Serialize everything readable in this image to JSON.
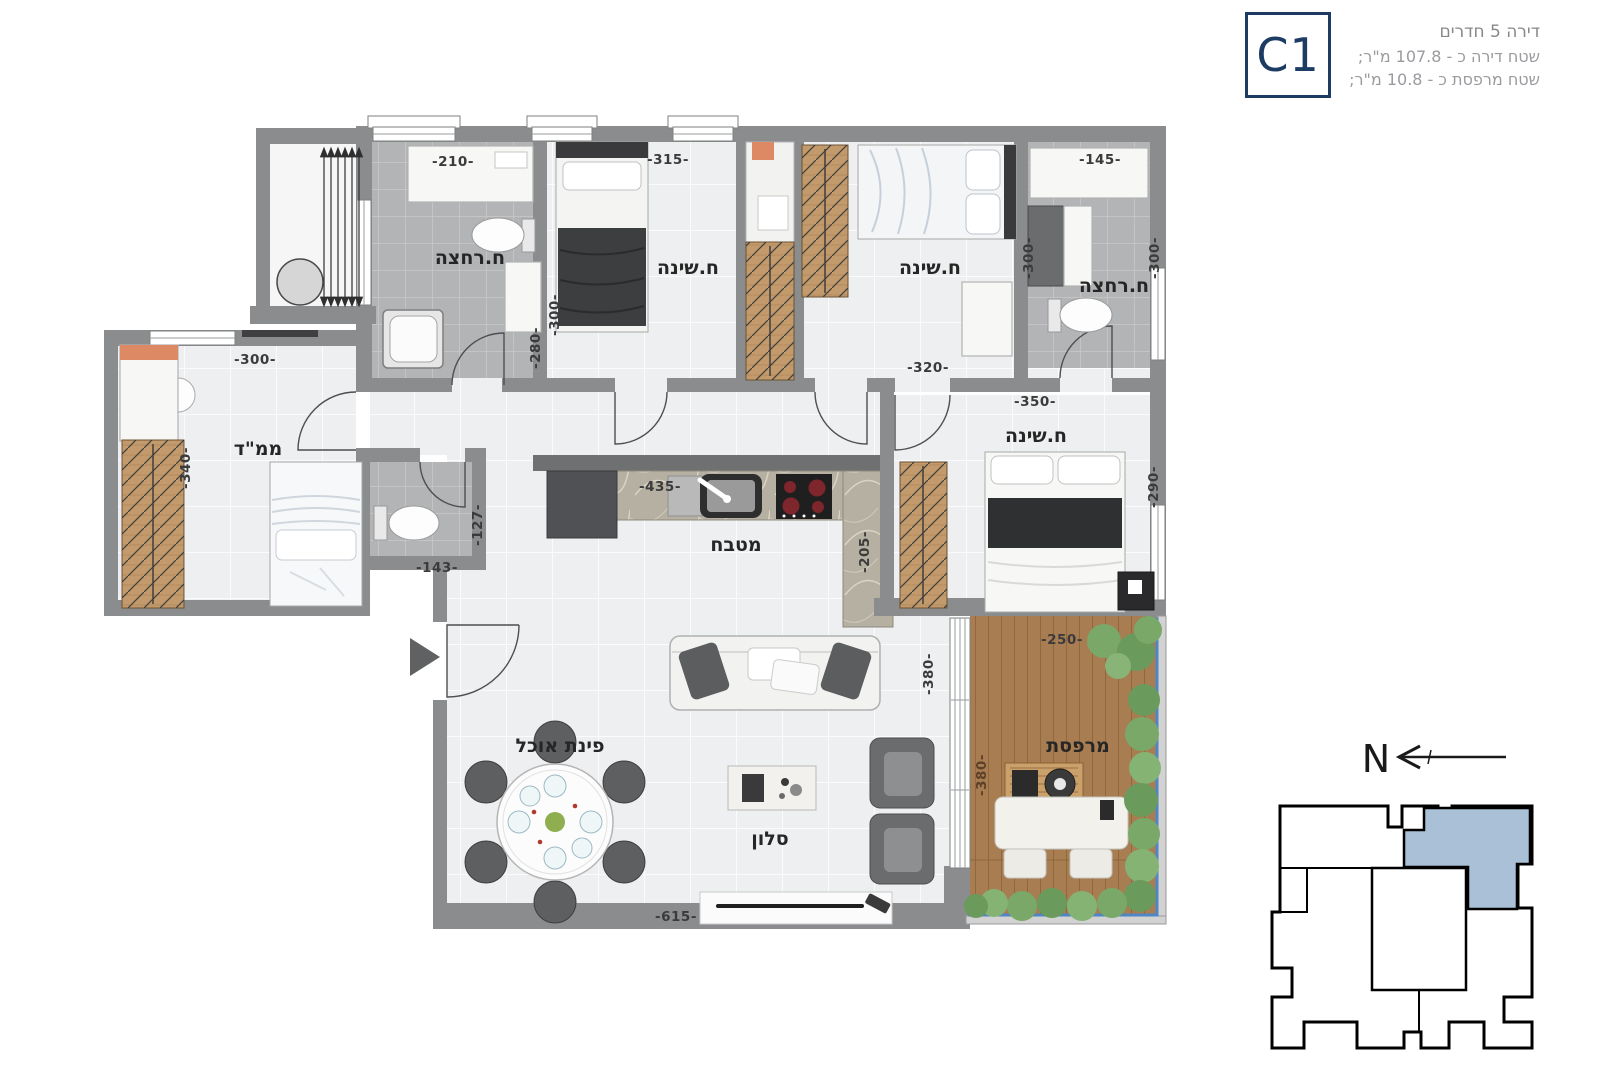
{
  "header": {
    "line1": "דירה 5 חדרים",
    "line2": "שטח דירה כ - 107.8 מ\"ר;",
    "line3": "שטח מרפסת כ - 10.8 מ\"ר;",
    "unit_code": "C1"
  },
  "compass": {
    "north_label": "N"
  },
  "colors": {
    "wall": "#8a8c8e",
    "unit_highlight": "#a9c0d6",
    "railing": "#4e86c6",
    "navy": "#1d3c63",
    "deck_wood": "#a87d52",
    "closet_wood": "#c39a6b",
    "greenery": "#79a869",
    "accent_orange": "#dd8a64"
  },
  "plan": {
    "rooms": {
      "bath1": "ח.רחצה",
      "bed1": "ח.שינה",
      "bed2": "ח.שינה",
      "bath2": "ח.רחצה",
      "mamad": "ממ\"ד",
      "master": "ח.שינה",
      "kitchen": "מטבח",
      "dining": "פינת אוכל",
      "living": "סלון",
      "balcony": "מרפסת"
    },
    "dims": {
      "bath1_width": "-210-",
      "bed1_width": "-315-",
      "bath2_width": "-145-",
      "bed1_depth": "-300-",
      "shower_depth": "-280-",
      "bed2_depth": "-300-",
      "bath2_depth": "-300-",
      "bed2_width": "-320-",
      "master_width": "-350-",
      "master_depth": "-290-",
      "mamad_width": "-300-",
      "mamad_depth": "-340-",
      "wc_depth": "-127-",
      "wc_width": "-143-",
      "kitchen_width": "-435-",
      "kitchen_depth": "-205-",
      "living_depth": "-380-",
      "balcony_depth": "-380-",
      "balcony_width": "-250-",
      "living_width": "-615-"
    }
  }
}
